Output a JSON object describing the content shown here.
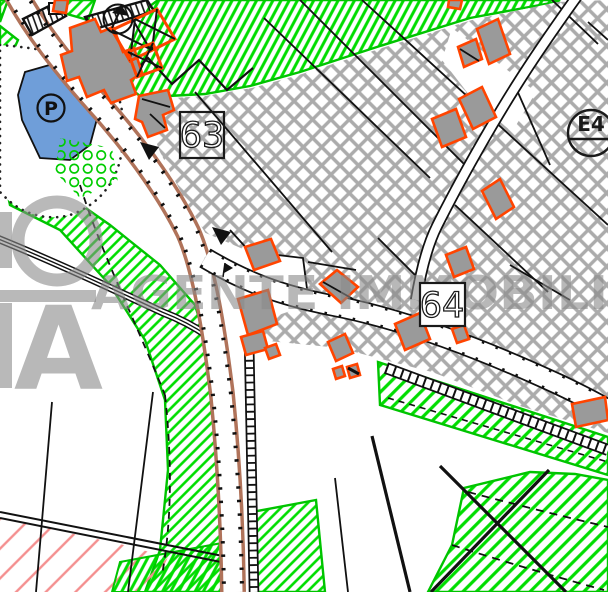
{
  "map": {
    "zone_labels": {
      "box_63": "63",
      "box_64": "64",
      "circle_e4": "E4"
    },
    "symbols": {
      "parking_label": "P",
      "flag_icon": "pennant-flag"
    },
    "watermark": {
      "logo_letter_a": "A",
      "agency_text": "AGENTE IMMOBILI"
    },
    "colors": {
      "green_zone_hatch": "#00dd00",
      "green_zone_border": "#00c400",
      "gray_crosshatch": "#ababab",
      "building_outline_orange": "#ff4400",
      "building_fill_gray": "#9a9a9a",
      "road_casing_brown": "#b0735a",
      "water_blue": "#6f9ed9",
      "red_hatch": "#f48f8f",
      "watermark_gray": "#8a8a8a",
      "line_black": "#111111"
    }
  }
}
